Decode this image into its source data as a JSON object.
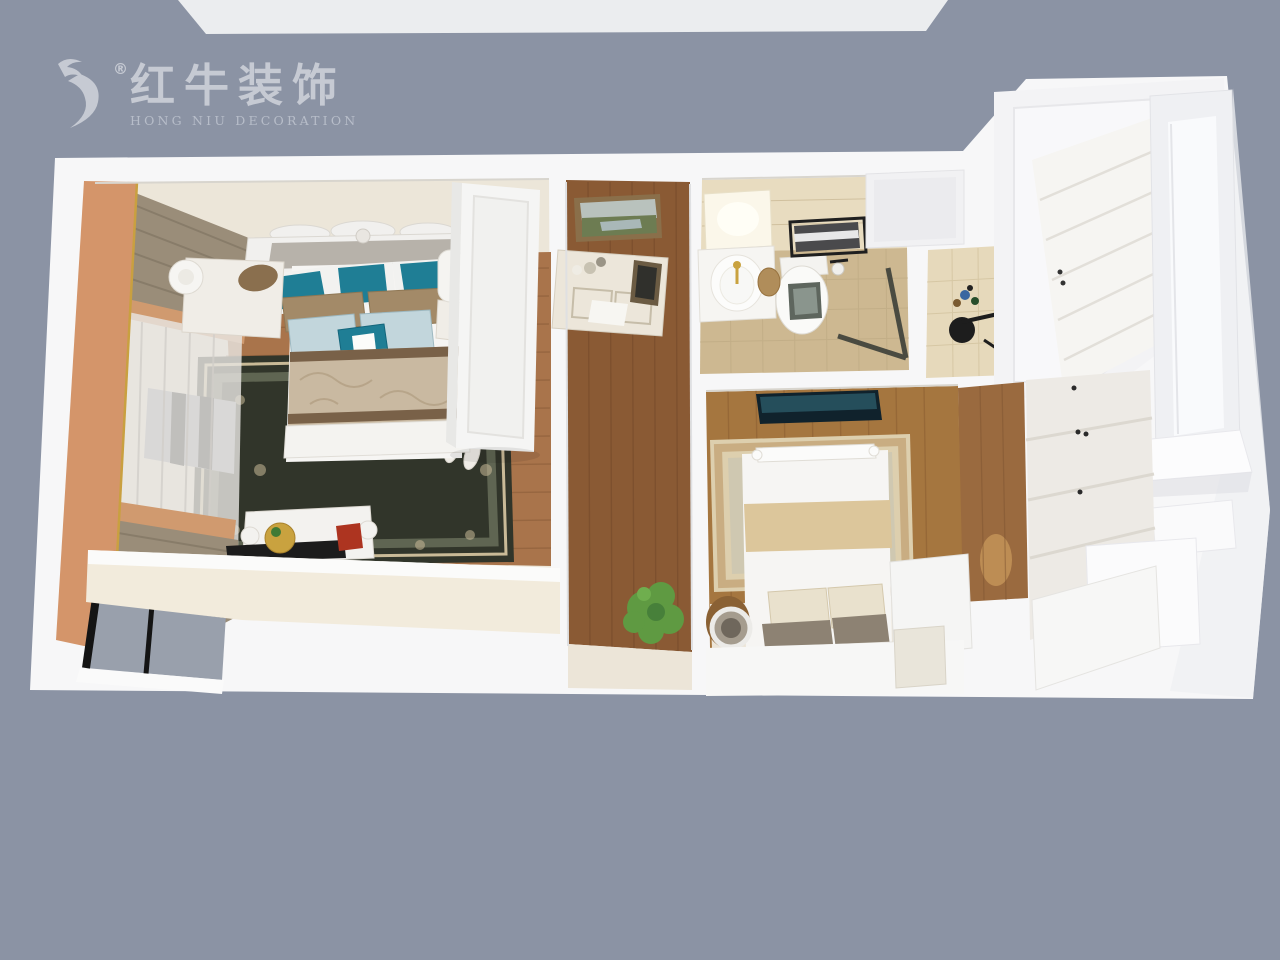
{
  "brand": {
    "logo_cn": "红牛装饰",
    "logo_en": "HONG NIU DECORATION",
    "registered_mark": "®"
  },
  "palette": {
    "background": "#8b93a4",
    "top_strip": "#ebedef",
    "wall": "#f7f7f8",
    "wall_shade": "#eff0f3",
    "floor_pale": "#ece6d9",
    "wood_bedroom1": "#a9744b",
    "wood_corridor": "#8a5a34",
    "wood_bedroom2": "#a5763f",
    "wood_hall": "#9a6a3f",
    "tile_wall": "#e8dcc0",
    "tile_floor": "#cdb891",
    "rug_dark": "#31352a",
    "rug_light": "#ddcfae",
    "curtain_khaki": "#9a8d79",
    "curtain_sheer": "#e7e4e0",
    "pelmet_orange": "#d4956a",
    "pillow_teal": "#1f7e95",
    "pillow_brown": "#a38a68",
    "pillow_blue": "#c2d6dc",
    "bed_white": "#f6f5f3",
    "runner_beige": "#c9b9a1",
    "tray_black": "#1c1c1c",
    "plant_green": "#5f9a42",
    "tv_screen": "#10222c",
    "glass_gray": "#99a0ac",
    "gold": "#c9a23f",
    "logo_text": "#c6cad3",
    "logo_sub": "#b7bdc9"
  }
}
